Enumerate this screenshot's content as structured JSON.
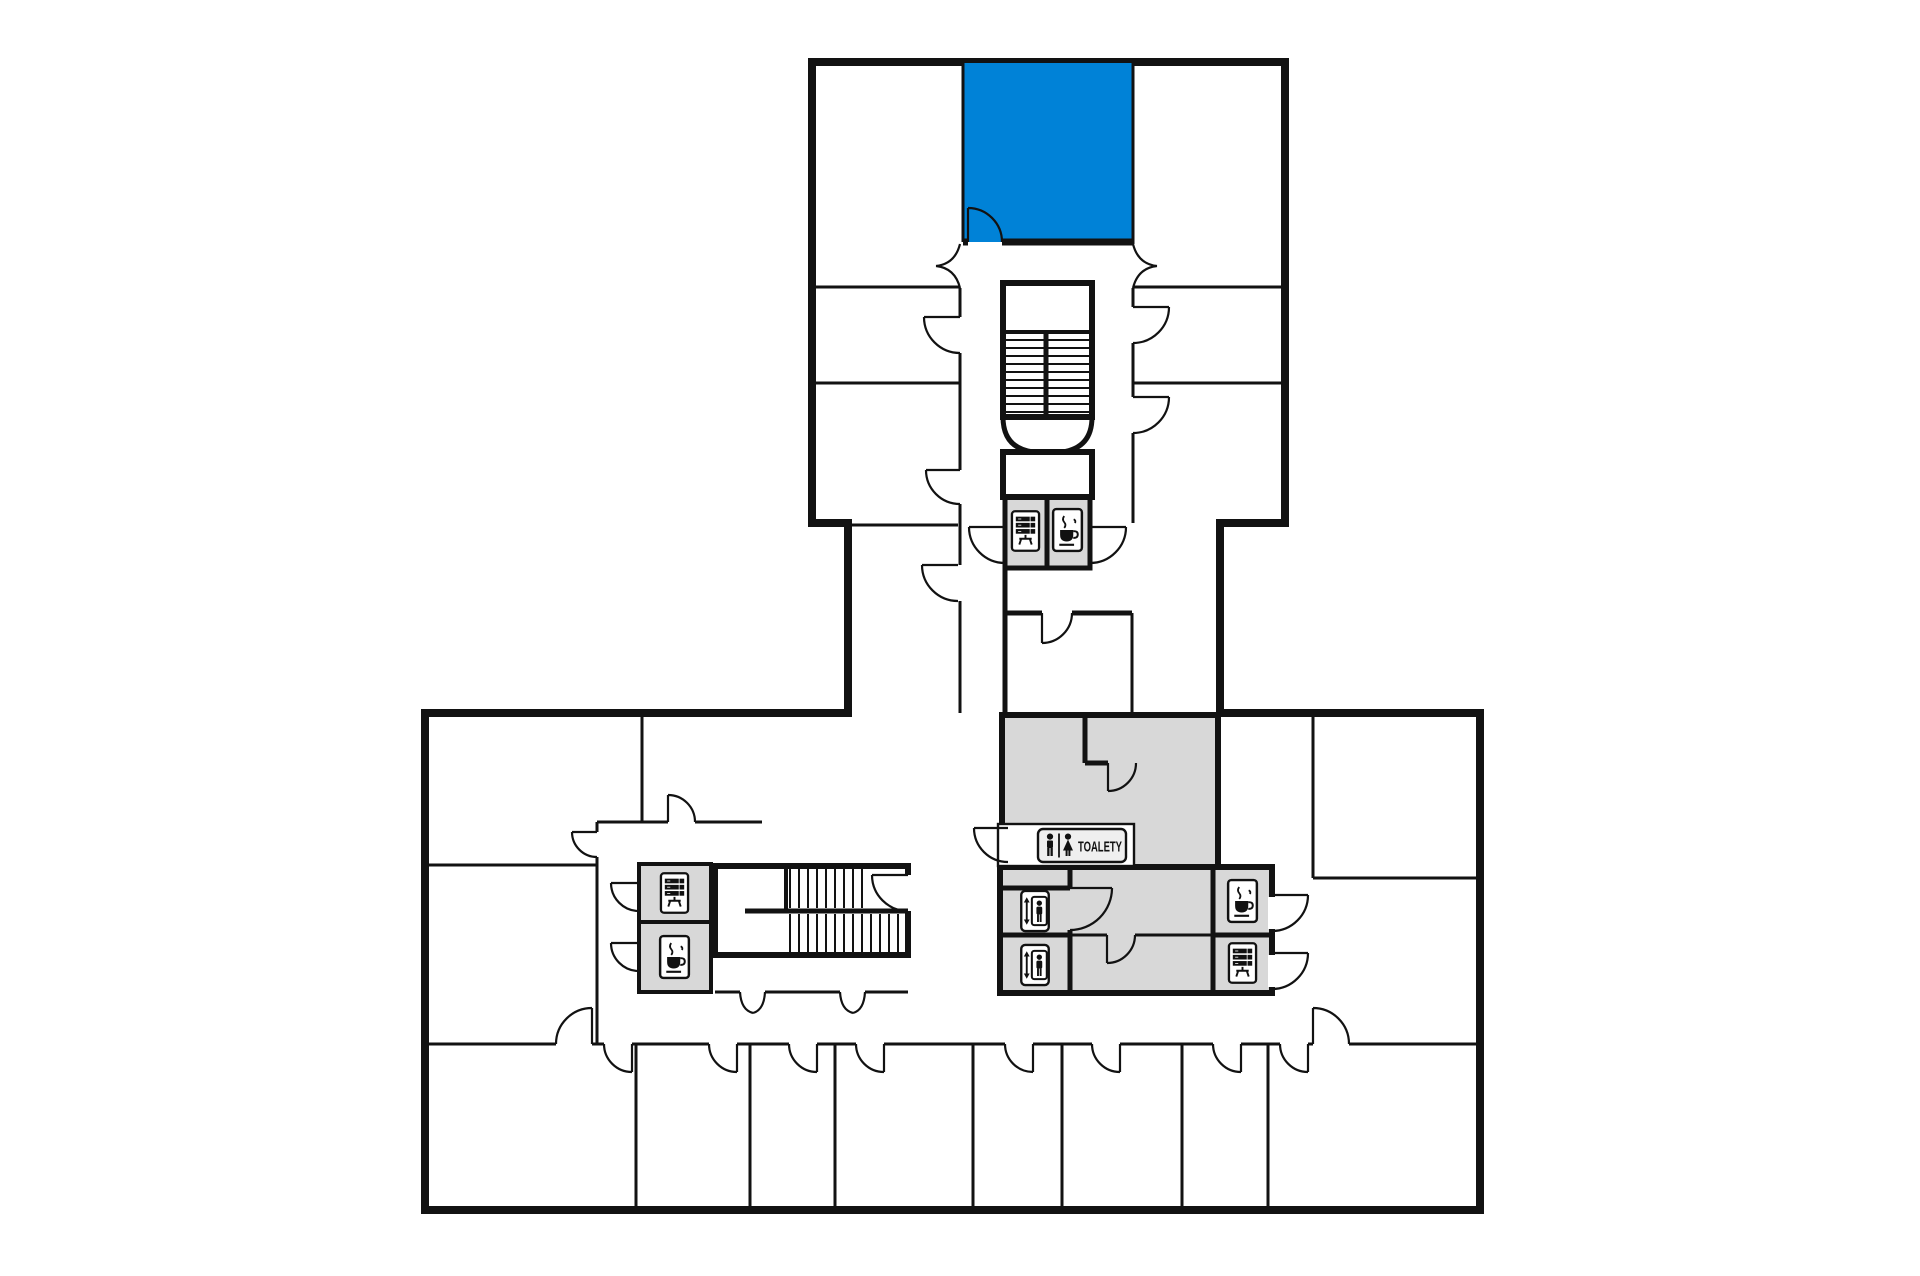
{
  "plan": {
    "labels": {
      "toilets": "TOALETY"
    },
    "colors": {
      "wall": "#121212",
      "highlight_room": "#0082d7",
      "service_room": "#d8d8d8",
      "sign_fill": "#efefef",
      "background": "#ffffff"
    },
    "icons": [
      {
        "name": "vending-machine-icon",
        "area": "tower-core"
      },
      {
        "name": "coffee-icon",
        "area": "tower-core"
      },
      {
        "name": "vending-machine-icon",
        "area": "west-stair-core"
      },
      {
        "name": "coffee-icon",
        "area": "west-stair-core"
      },
      {
        "name": "elevator-icon",
        "area": "central-core"
      },
      {
        "name": "elevator-icon",
        "area": "central-core"
      },
      {
        "name": "coffee-icon",
        "area": "central-core"
      },
      {
        "name": "vending-machine-icon",
        "area": "central-core"
      },
      {
        "name": "wc-men-icon",
        "area": "toilet-sign"
      },
      {
        "name": "wc-women-icon",
        "area": "toilet-sign"
      }
    ]
  }
}
